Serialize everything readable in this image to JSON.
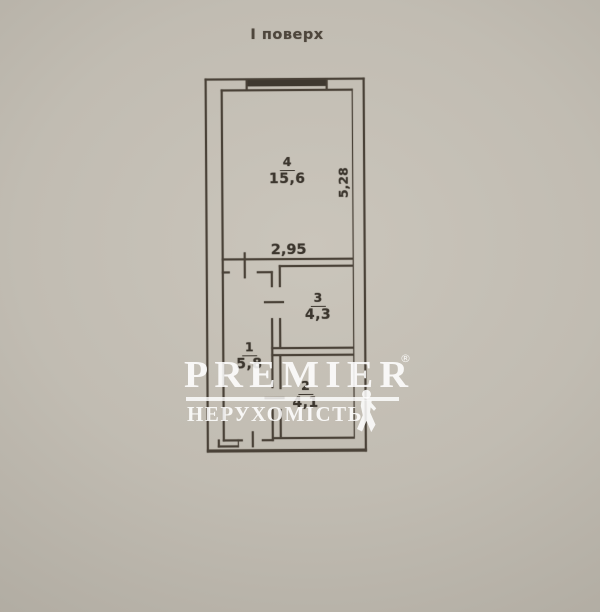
{
  "photo": {
    "title": "І поверх"
  },
  "colors": {
    "background": "#bcb7ad",
    "line": "#4a4238",
    "label": "#3c362e",
    "watermark": "#ffffff"
  },
  "plan": {
    "rooms": [
      {
        "number": "4",
        "area": "15,6",
        "cx": 288,
        "cy": 152
      },
      {
        "number": "3",
        "area": "4,3",
        "cx": 318,
        "cy": 288
      },
      {
        "number": "1",
        "area": "5,8",
        "cx": 249,
        "cy": 337
      },
      {
        "number": "2",
        "area": "4,1",
        "cx": 305,
        "cy": 376
      }
    ],
    "dimensions": [
      {
        "text": "2,95",
        "cx": 289,
        "cy": 250,
        "rotated": false
      },
      {
        "text": "5,28",
        "cx": 344,
        "cy": 183,
        "rotated": true
      }
    ],
    "window": {
      "x": 249,
      "y": 80,
      "w": 78,
      "h": 6
    },
    "walls": [
      {
        "x": 206,
        "y": 78,
        "w": 160,
        "h": 2.2
      },
      {
        "x": 206,
        "y": 78,
        "w": 2.2,
        "h": 374
      },
      {
        "x": 364,
        "y": 78,
        "w": 2.2,
        "h": 374
      },
      {
        "x": 206,
        "y": 449,
        "w": 160,
        "h": 2.6
      },
      {
        "x": 222,
        "y": 89,
        "w": 132,
        "h": 1.7
      },
      {
        "x": 222,
        "y": 89,
        "w": 1.7,
        "h": 352
      },
      {
        "x": 352.5,
        "y": 89,
        "w": 1.7,
        "h": 350
      },
      {
        "x": 247,
        "y": 79,
        "w": 1.5,
        "h": 11
      },
      {
        "x": 327,
        "y": 79,
        "w": 1.5,
        "h": 11
      },
      {
        "x": 222,
        "y": 258,
        "w": 131,
        "h": 1.7
      },
      {
        "x": 222,
        "y": 271,
        "w": 8,
        "h": 1.7
      },
      {
        "x": 257,
        "y": 271,
        "w": 16,
        "h": 1.7
      },
      {
        "x": 279,
        "y": 265,
        "w": 74,
        "h": 1.7
      },
      {
        "x": 244,
        "y": 252,
        "w": 1.7,
        "h": 26
      },
      {
        "x": 271,
        "y": 271,
        "w": 1.7,
        "h": 16
      },
      {
        "x": 271,
        "y": 318,
        "w": 1.7,
        "h": 70
      },
      {
        "x": 271,
        "y": 409,
        "w": 1.7,
        "h": 32
      },
      {
        "x": 279,
        "y": 265,
        "w": 1.7,
        "h": 22
      },
      {
        "x": 279,
        "y": 318,
        "w": 1.7,
        "h": 30
      },
      {
        "x": 279,
        "y": 355,
        "w": 1.7,
        "h": 34
      },
      {
        "x": 279,
        "y": 409,
        "w": 1.7,
        "h": 29
      },
      {
        "x": 264,
        "y": 301,
        "w": 20,
        "h": 1.7
      },
      {
        "x": 264,
        "y": 397,
        "w": 20,
        "h": 1.7
      },
      {
        "x": 271,
        "y": 347,
        "w": 82,
        "h": 1.7
      },
      {
        "x": 271,
        "y": 354,
        "w": 82,
        "h": 1.7
      },
      {
        "x": 222,
        "y": 439,
        "w": 20,
        "h": 1.7
      },
      {
        "x": 261,
        "y": 439,
        "w": 12,
        "h": 1.7
      },
      {
        "x": 251,
        "y": 431,
        "w": 1.7,
        "h": 16
      },
      {
        "x": 217,
        "y": 439,
        "w": 1.7,
        "h": 8
      },
      {
        "x": 217,
        "y": 445,
        "w": 21,
        "h": 1.7
      },
      {
        "x": 236.5,
        "y": 439,
        "w": 1.7,
        "h": 8
      },
      {
        "x": 272,
        "y": 437,
        "w": 81,
        "h": 1.7
      }
    ]
  },
  "watermark": {
    "brand": "PREMIER",
    "registered": "®",
    "subtitle": "НЕРУХОМІСТЬ"
  }
}
